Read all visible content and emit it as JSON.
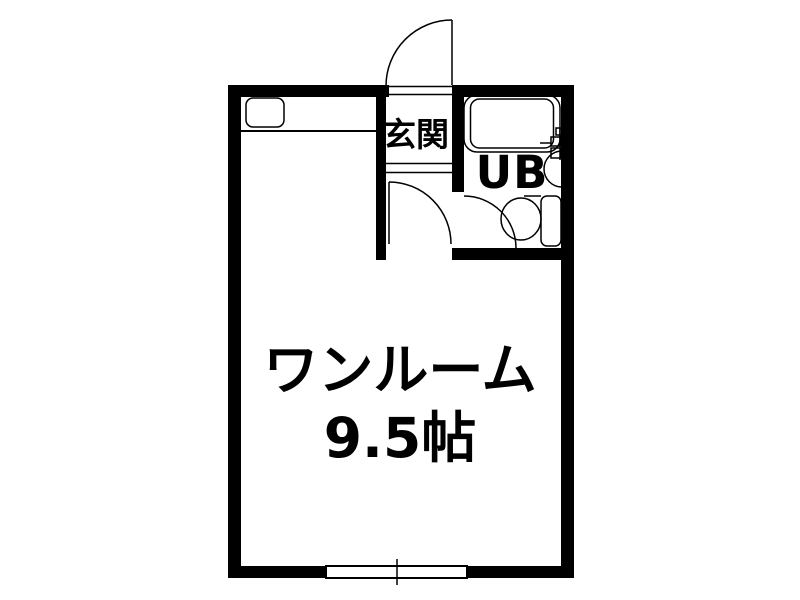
{
  "colors": {
    "wall": "#000000",
    "line": "#000000",
    "background": "#ffffff",
    "text": "#000000"
  },
  "floorplan": {
    "main_room": {
      "name": "ワンルーム",
      "size": "9.5帖"
    },
    "entrance": {
      "label": "玄関"
    },
    "bathroom": {
      "label": "UB"
    },
    "fixtures": [
      "entrance-door",
      "kitchen-sink",
      "kitchen-counter",
      "room-door",
      "bath-door",
      "bathtub",
      "faucet-unit",
      "washbasin",
      "toilet",
      "sliding-window"
    ]
  }
}
